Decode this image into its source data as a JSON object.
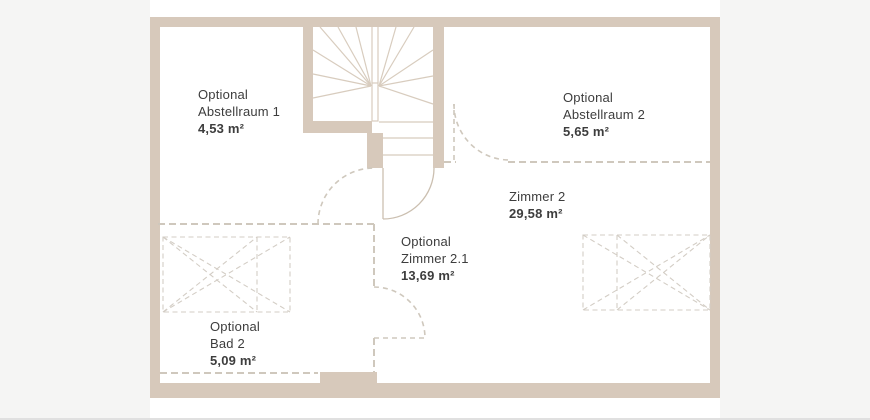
{
  "plan": {
    "title": "floor-plan-upper-level",
    "colors": {
      "wall": "#d7c9bb",
      "panel": "#ffffff",
      "margin": "#f5f5f4",
      "dashed_partition": "#cfc8bd",
      "stair_lines": "#d8ccbe",
      "door_arc": "#cbbfb0",
      "furniture_dash": "#d3cdc5",
      "text": "#3d3d3d"
    }
  },
  "rooms": [
    {
      "prefix": "Optional",
      "name": "Abstellraum 1",
      "area": "4,53 m²"
    },
    {
      "prefix": "Optional",
      "name": "Abstellraum 2",
      "area": "5,65 m²"
    },
    {
      "name": "Zimmer 2",
      "area": "29,58 m²"
    },
    {
      "prefix": "Optional",
      "name": "Zimmer 2.1",
      "area": "13,69 m²"
    },
    {
      "prefix": "Optional",
      "name": "Bad 2",
      "area": "5,09 m²"
    }
  ]
}
